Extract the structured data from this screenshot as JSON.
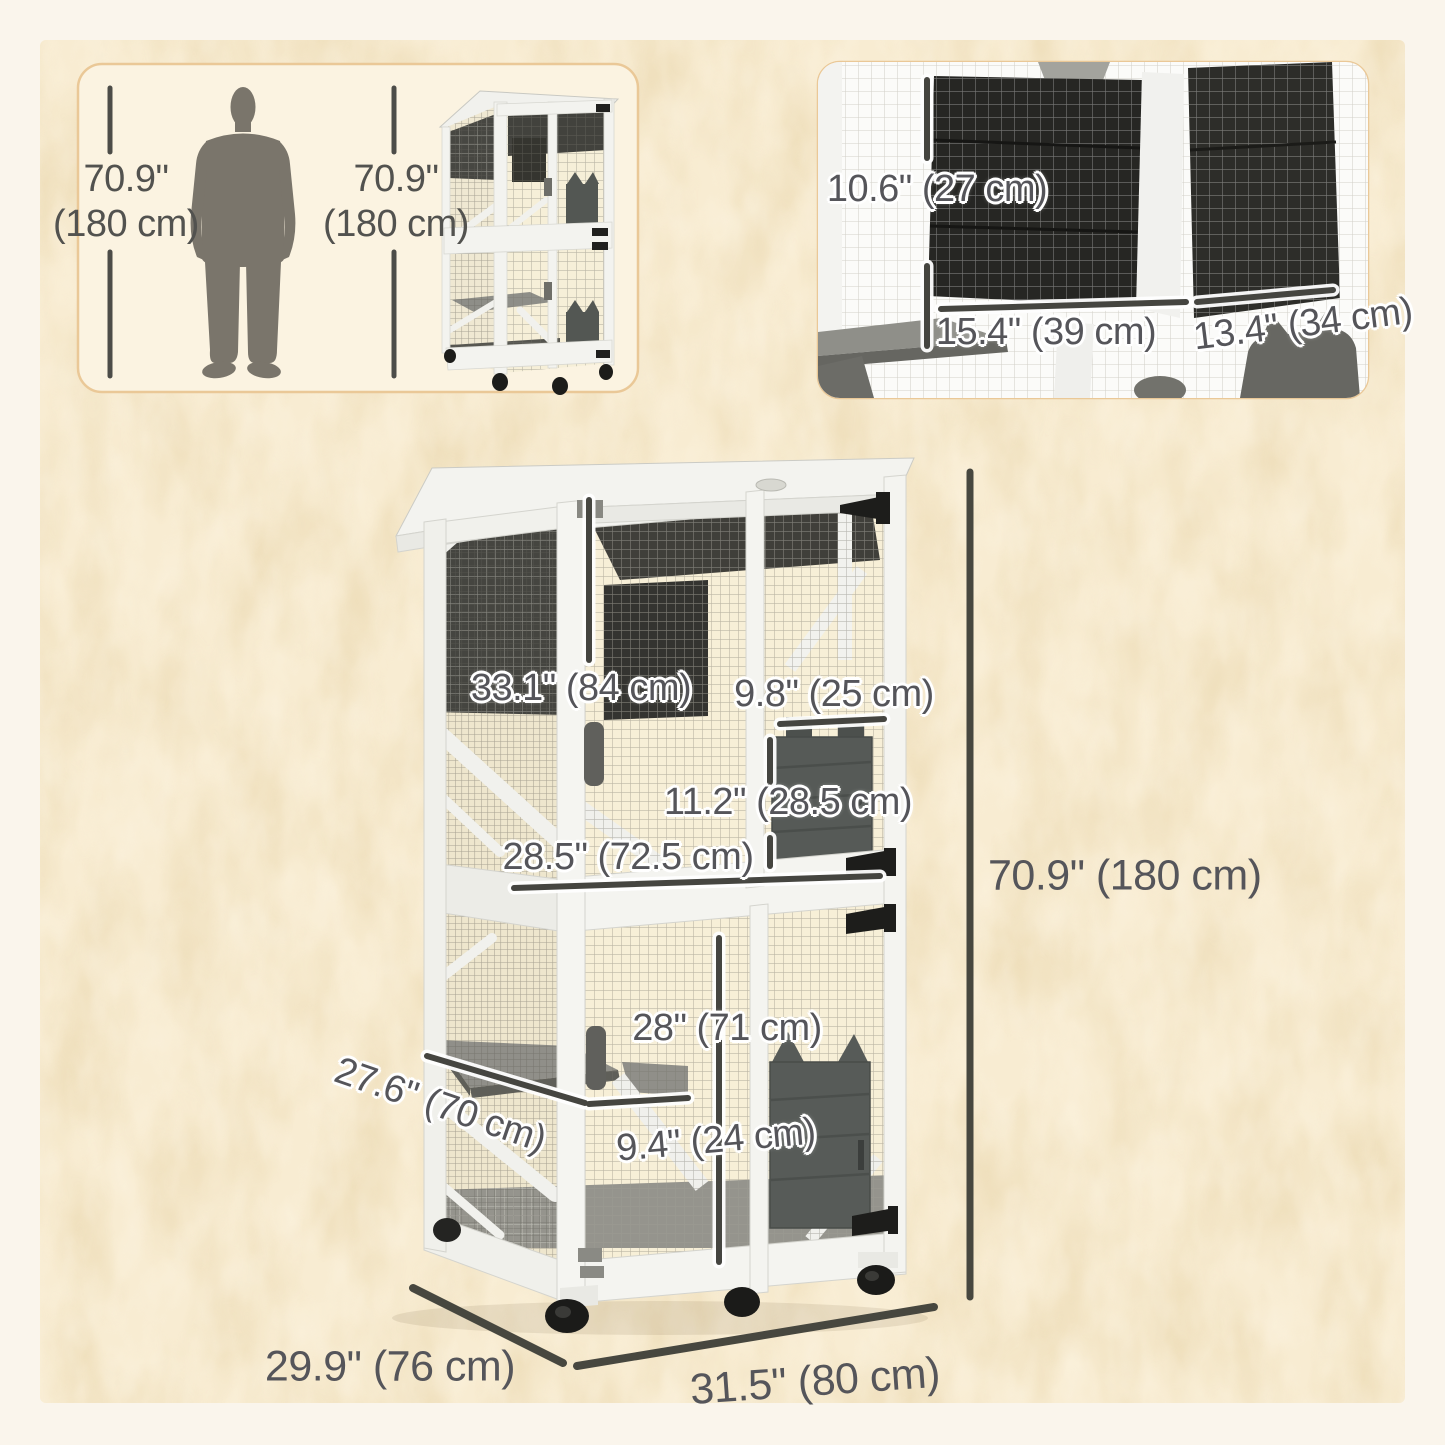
{
  "colors": {
    "page_bg": "#faf5ec",
    "canvas_bg": "#f8ecd2",
    "canvas_mottle": "#e6d2a6",
    "panel_bg": "#fbf3e1",
    "panel_border": "#eac897",
    "label_color": "#55555a",
    "dim_line": "#47473f",
    "cage_white": "#f4f4f0",
    "mesh_dark_panel": "#403f3a",
    "flap_gray": "#575b58",
    "shelf_gray": "#908f89"
  },
  "scale_panel": {
    "left_height": {
      "value": "70.9\"",
      "unit": "(180 cm)"
    },
    "right_height": {
      "value": "70.9\"",
      "unit": "(180 cm)"
    }
  },
  "closeup_panel": {
    "hatch_height": "10.6\" (27 cm)",
    "left_shelf_width": "15.4\" (39 cm)",
    "right_shelf_width": "13.4\" (34 cm)"
  },
  "main_diagram": {
    "upper_section_height": "33.1\" (84 cm)",
    "flap_width": "9.8\" (25 cm)",
    "flap_height": "11.2\" (28.5 cm)",
    "interior_width": "28.5\" (72.5 cm)",
    "overall_height": "70.9\" (180 cm)",
    "lower_door_height": "28\" (71 cm)",
    "shelf_depth": "27.6\" (70 cm)",
    "shelf_gap": "9.4\" (24 cm)",
    "overall_depth": "29.9\" (76 cm)",
    "overall_width": "31.5\" (80 cm)"
  }
}
